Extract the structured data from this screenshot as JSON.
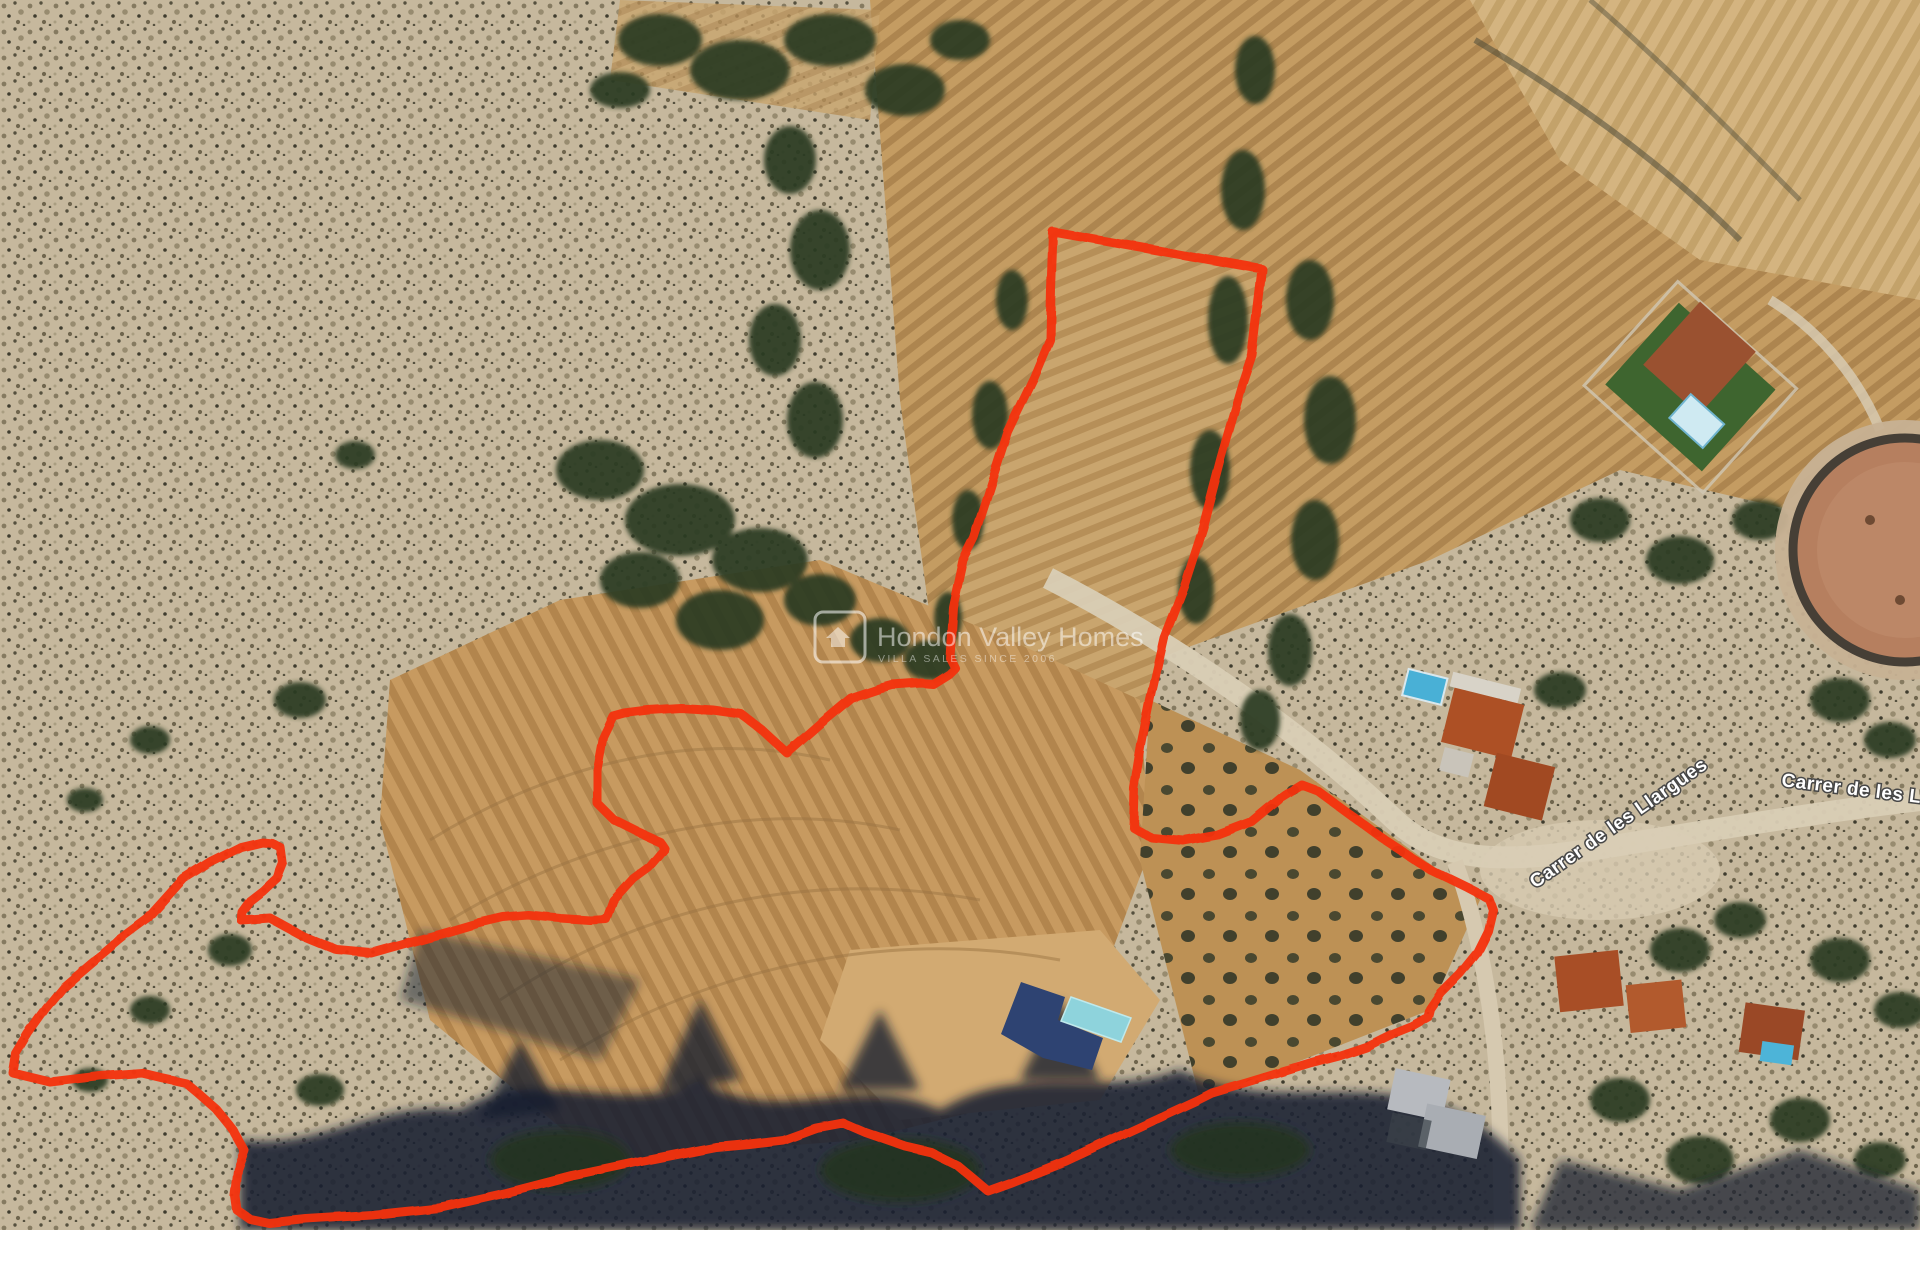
{
  "map": {
    "street_labels": [
      {
        "text": "Carrer de les Llargues"
      },
      {
        "text": "Carrer de les Llargues"
      }
    ],
    "watermark": {
      "title": "Hondon Valley Homes",
      "subtitle": "VILLA SALES SINCE 2006",
      "color": "#ffffff"
    },
    "overlays": {
      "boundary": {
        "color": "#f5320e",
        "stroke_width": 9,
        "points": [
          [
            1053,
            232
          ],
          [
            1262,
            269
          ],
          [
            1252,
            355
          ],
          [
            1243,
            382
          ],
          [
            1221,
            458
          ],
          [
            1203,
            527
          ],
          [
            1184,
            586
          ],
          [
            1164,
            638
          ],
          [
            1150,
            700
          ],
          [
            1141,
            745
          ],
          [
            1134,
            788
          ],
          [
            1133,
            827
          ],
          [
            1152,
            838
          ],
          [
            1184,
            841
          ],
          [
            1218,
            835
          ],
          [
            1252,
            822
          ],
          [
            1281,
            798
          ],
          [
            1302,
            785
          ],
          [
            1318,
            791
          ],
          [
            1382,
            838
          ],
          [
            1431,
            870
          ],
          [
            1468,
            888
          ],
          [
            1489,
            899
          ],
          [
            1493,
            910
          ],
          [
            1488,
            931
          ],
          [
            1477,
            953
          ],
          [
            1460,
            974
          ],
          [
            1441,
            993
          ],
          [
            1430,
            1009
          ],
          [
            1428,
            1017
          ],
          [
            1412,
            1026
          ],
          [
            1392,
            1034
          ],
          [
            1366,
            1047
          ],
          [
            1339,
            1056
          ],
          [
            1312,
            1063
          ],
          [
            1279,
            1073
          ],
          [
            1246,
            1083
          ],
          [
            1212,
            1093
          ],
          [
            1196,
            1101
          ],
          [
            1133,
            1130
          ],
          [
            1066,
            1161
          ],
          [
            1010,
            1183
          ],
          [
            988,
            1191
          ],
          [
            958,
            1166
          ],
          [
            932,
            1153
          ],
          [
            906,
            1147
          ],
          [
            866,
            1133
          ],
          [
            843,
            1123
          ],
          [
            816,
            1128
          ],
          [
            783,
            1140
          ],
          [
            749,
            1144
          ],
          [
            716,
            1147
          ],
          [
            639,
            1162
          ],
          [
            572,
            1176
          ],
          [
            506,
            1193
          ],
          [
            439,
            1208
          ],
          [
            372,
            1215
          ],
          [
            306,
            1219
          ],
          [
            269,
            1223
          ],
          [
            250,
            1219
          ],
          [
            237,
            1210
          ],
          [
            235,
            1196
          ],
          [
            238,
            1170
          ],
          [
            245,
            1151
          ],
          [
            233,
            1130
          ],
          [
            216,
            1109
          ],
          [
            200,
            1095
          ],
          [
            186,
            1083
          ],
          [
            163,
            1078
          ],
          [
            142,
            1073
          ],
          [
            100,
            1076
          ],
          [
            50,
            1082
          ],
          [
            13,
            1073
          ],
          [
            16,
            1054
          ],
          [
            28,
            1034
          ],
          [
            46,
            1009
          ],
          [
            64,
            987
          ],
          [
            91,
            964
          ],
          [
            121,
            939
          ],
          [
            148,
            919
          ],
          [
            184,
            879
          ],
          [
            211,
            862
          ],
          [
            241,
            847
          ],
          [
            262,
            842
          ],
          [
            272,
            843
          ],
          [
            281,
            848
          ],
          [
            283,
            863
          ],
          [
            277,
            878
          ],
          [
            263,
            891
          ],
          [
            250,
            901
          ],
          [
            242,
            912
          ],
          [
            241,
            920
          ],
          [
            270,
            918
          ],
          [
            303,
            936
          ],
          [
            337,
            950
          ],
          [
            371,
            953
          ],
          [
            410,
            942
          ],
          [
            443,
            933
          ],
          [
            477,
            923
          ],
          [
            503,
            917
          ],
          [
            528,
            915
          ],
          [
            560,
            918
          ],
          [
            590,
            920
          ],
          [
            606,
            919
          ],
          [
            613,
            900
          ],
          [
            633,
            878
          ],
          [
            648,
            867
          ],
          [
            664,
            848
          ],
          [
            660,
            842
          ],
          [
            640,
            833
          ],
          [
            614,
            820
          ],
          [
            597,
            803
          ],
          [
            597,
            770
          ],
          [
            603,
            737
          ],
          [
            613,
            716
          ],
          [
            624,
            713
          ],
          [
            648,
            710
          ],
          [
            681,
            708
          ],
          [
            713,
            710
          ],
          [
            741,
            714
          ],
          [
            762,
            730
          ],
          [
            787,
            753
          ],
          [
            820,
            724
          ],
          [
            851,
            698
          ],
          [
            881,
            688
          ],
          [
            892,
            685
          ],
          [
            921,
            683
          ],
          [
            933,
            684
          ],
          [
            949,
            674
          ],
          [
            955,
            668
          ],
          [
            950,
            658
          ],
          [
            953,
            607
          ],
          [
            963,
            560
          ],
          [
            974,
            538
          ],
          [
            1008,
            432
          ],
          [
            1034,
            378
          ],
          [
            1050,
            340
          ],
          [
            1051,
            290
          ]
        ]
      },
      "building": {
        "color": "#2e4372",
        "points": [
          [
            1001,
            1034
          ],
          [
            1021,
            982
          ],
          [
            1065,
            997
          ],
          [
            1058,
            1020
          ],
          [
            1103,
            1038
          ],
          [
            1092,
            1070
          ],
          [
            1043,
            1058
          ]
        ]
      },
      "pool": {
        "color": "#8ed3dc",
        "points": [
          [
            1071,
            997
          ],
          [
            1131,
            1018
          ],
          [
            1121,
            1042
          ],
          [
            1061,
            1021
          ]
        ]
      }
    }
  }
}
